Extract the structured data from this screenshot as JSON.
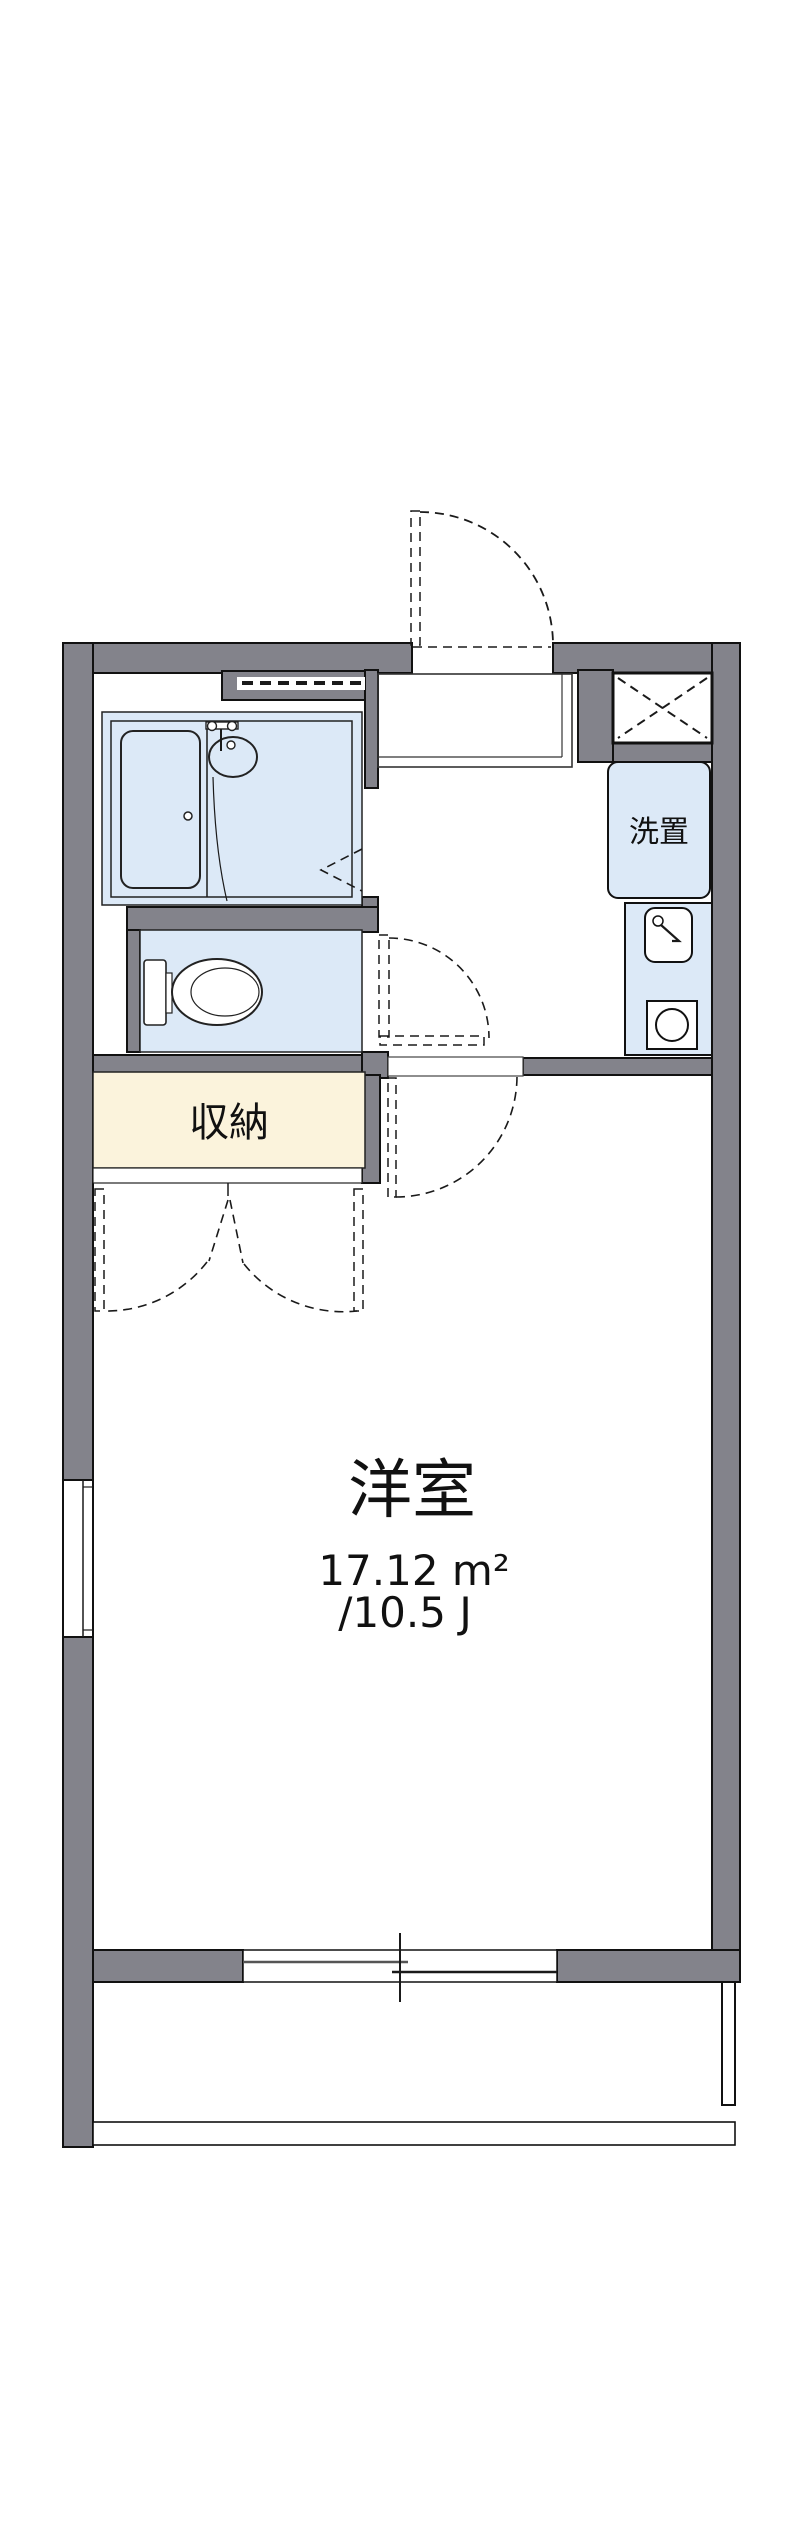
{
  "plan": {
    "rooms": {
      "main_room": {
        "name": "洋室",
        "area_sqm": "17.12 m²",
        "area_tatami": "/10.5 J"
      },
      "storage": {
        "label": "収納"
      },
      "washer": {
        "label": "洗置"
      }
    },
    "colors": {
      "wall_gray": "#83838b",
      "fixture_blue": "#dce9f7",
      "storage_cream": "#fbf3dc",
      "outline_black": "#1a1a1a",
      "background": "#ffffff"
    }
  }
}
